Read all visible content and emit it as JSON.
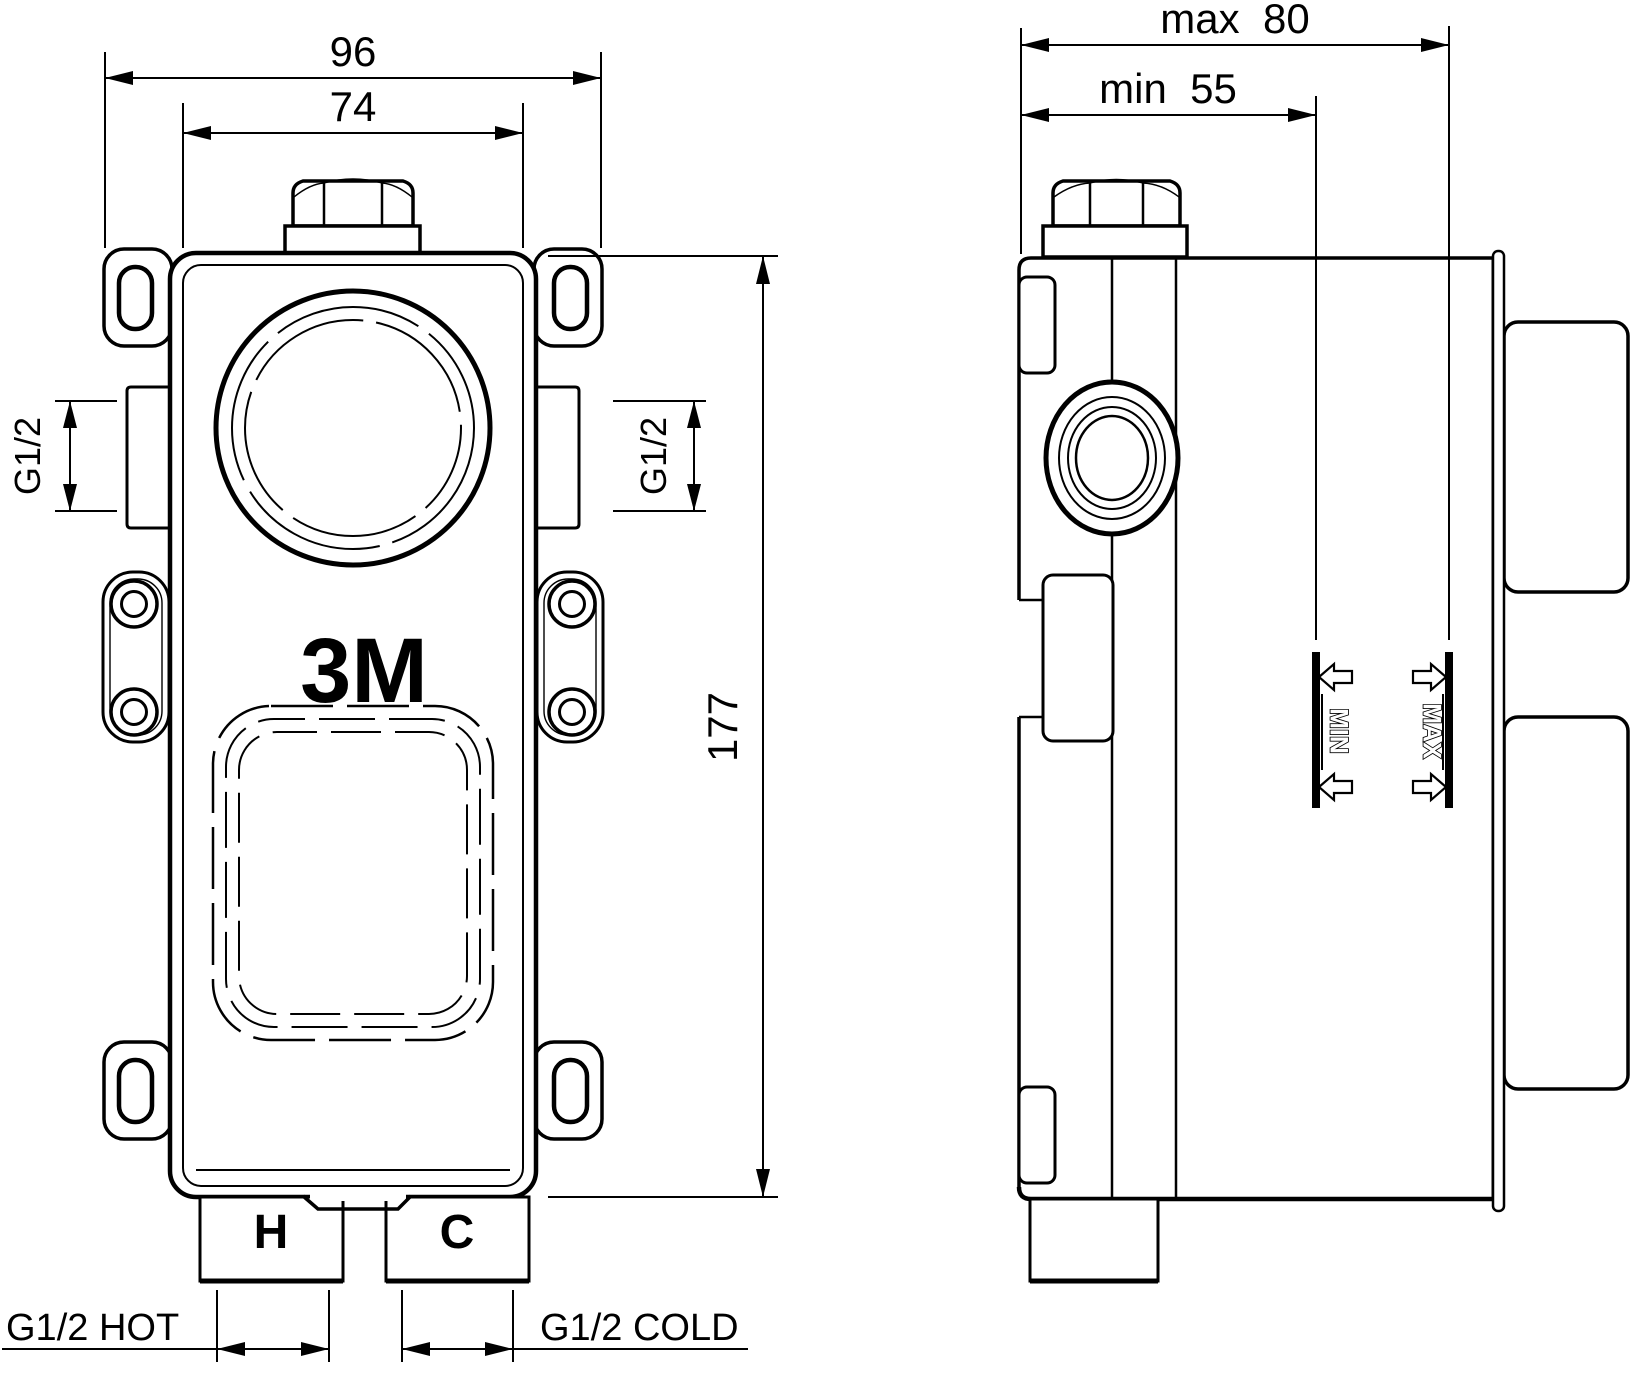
{
  "front": {
    "dim_width_outer": "96",
    "dim_width_inner": "74",
    "dim_height": "177",
    "thread_left": "G1/2",
    "thread_right": "G1/2",
    "logo": "3M",
    "hot_letter": "H",
    "cold_letter": "C",
    "hot_label": "G1/2 HOT",
    "cold_label": "G1/2 COLD"
  },
  "side": {
    "dim_depth_max": "max  80",
    "dim_depth_min": "min  55",
    "marker_min": "MIN",
    "marker_max": "MAX"
  },
  "colors": {
    "line": "#000000",
    "background": "#ffffff"
  }
}
